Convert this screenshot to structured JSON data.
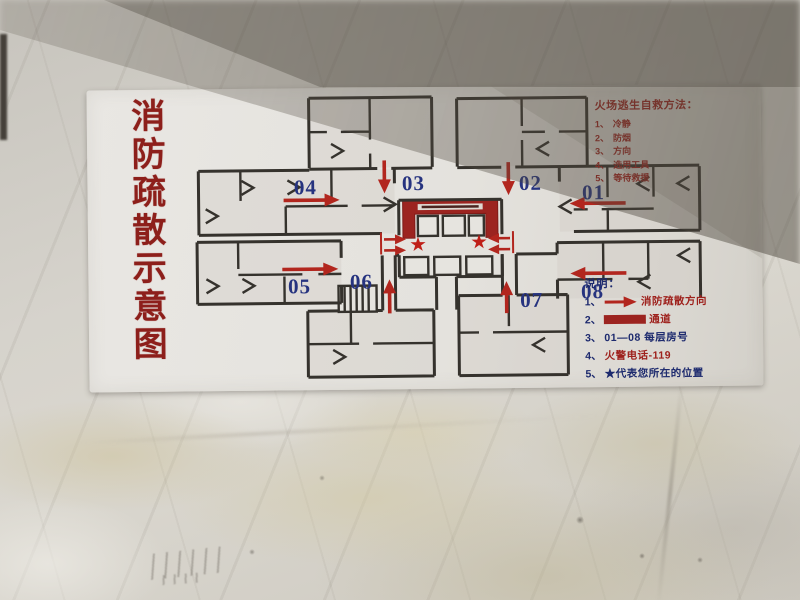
{
  "sign": {
    "title": "消防疏散示意图",
    "escape_guide": {
      "title": "火场逃生自救方法：",
      "items": [
        {
          "num": "1、",
          "text": "冷静"
        },
        {
          "num": "2、",
          "text": "防烟"
        },
        {
          "num": "3、",
          "text": "方向"
        },
        {
          "num": "4、",
          "text": "选用工具"
        },
        {
          "num": "5、",
          "text": "等待救援"
        }
      ]
    },
    "plan": {
      "rooms": [
        "01",
        "02",
        "03",
        "04",
        "05",
        "06",
        "07",
        "08"
      ],
      "star": "★"
    },
    "legend": {
      "title": "说明：",
      "items": [
        {
          "num": "1、",
          "icon": "evacuation-arrow-icon",
          "text": "消防疏散方向"
        },
        {
          "num": "2、",
          "icon": "corridor-bar-icon",
          "text": "通道"
        },
        {
          "num": "3、",
          "icon": "",
          "text": "01—08  每层房号"
        },
        {
          "num": "4、",
          "icon": "",
          "text": "火警电话-119"
        },
        {
          "num": "5、",
          "icon": "",
          "text": "★代表您所在的位置"
        }
      ]
    },
    "colors": {
      "sign_red": "#9e211c",
      "label_blue": "#26337f",
      "corridor_red": "#9c2420",
      "wall_ink": "#35322d"
    }
  }
}
